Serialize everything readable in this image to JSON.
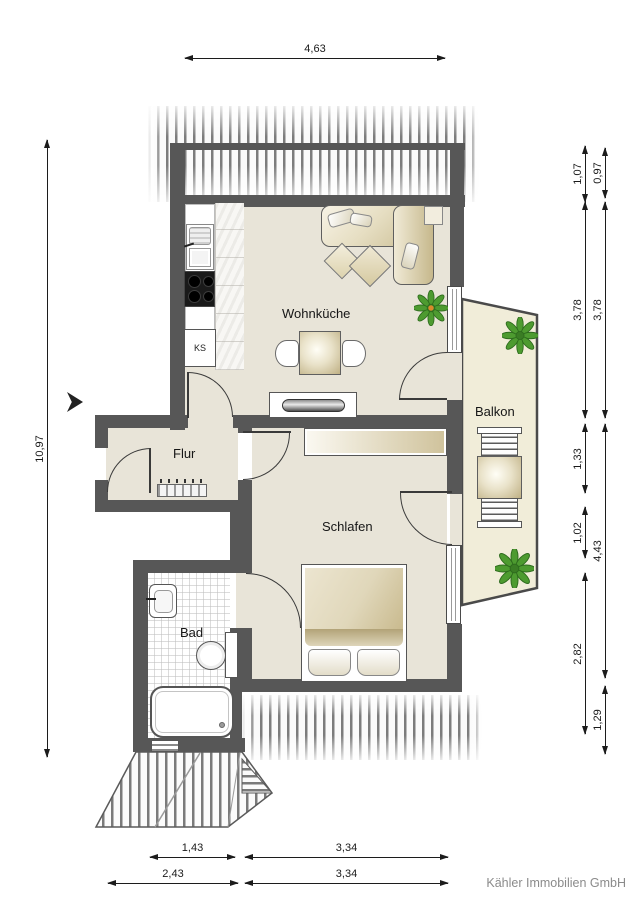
{
  "plan_title": "apartment-floor-plan",
  "rooms": {
    "wohnkueche": {
      "label": "Wohnküche"
    },
    "flur": {
      "label": "Flur"
    },
    "balkon": {
      "label": "Balkon"
    },
    "schlafen": {
      "label": "Schlafen"
    },
    "bad": {
      "label": "Bad"
    }
  },
  "kitchen": {
    "fridge_label": "KS"
  },
  "dimensions": {
    "top": {
      "label": "4,63"
    },
    "left": {
      "label": "10,97"
    },
    "right_inner": [
      {
        "label": "1,07"
      },
      {
        "label": "3,78"
      },
      {
        "label": "1,33"
      },
      {
        "label": "1,02"
      },
      {
        "label": "2,82"
      }
    ],
    "right_outer": [
      {
        "label": "0,97"
      },
      {
        "label": "3,78"
      },
      {
        "label": "4,43"
      },
      {
        "label": "1,29"
      }
    ],
    "bottom_inner": [
      {
        "label": "1,43"
      },
      {
        "label": "3,34"
      }
    ],
    "bottom_outer": [
      {
        "label": "2,43"
      },
      {
        "label": "3,34"
      }
    ]
  },
  "colors": {
    "wall": "#575757",
    "floor": "#e8e4d8",
    "balcony_floor": "#f1edd9",
    "furniture_beige": "#d8cca8",
    "plant_green": "#4d9b30"
  },
  "branding": {
    "company": "Kähler Immobilien GmbH"
  }
}
